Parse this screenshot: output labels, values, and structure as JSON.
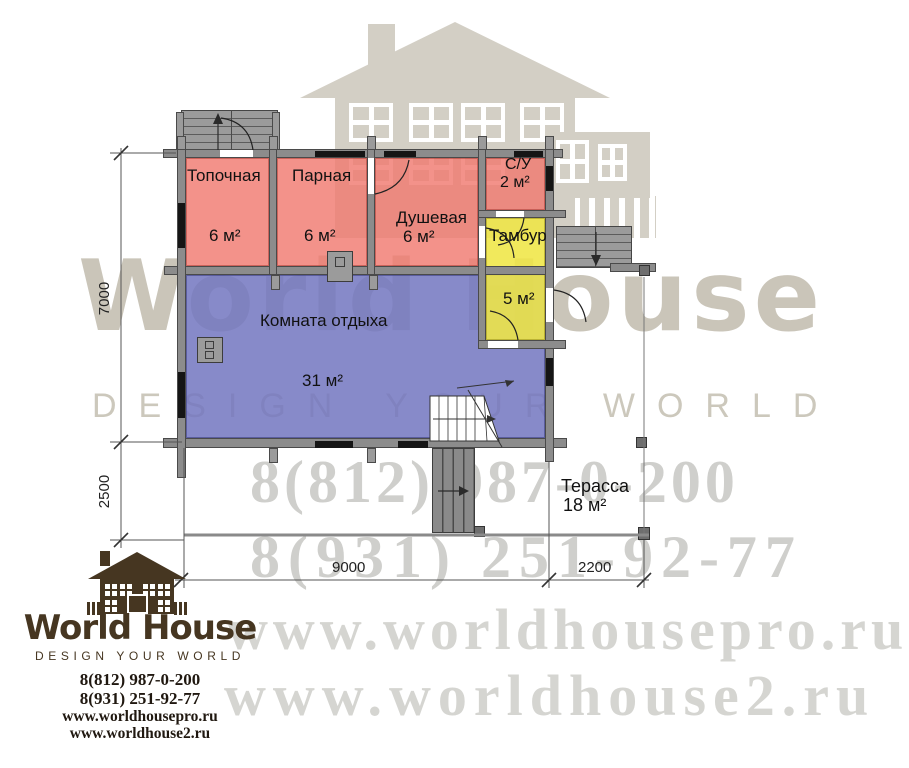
{
  "plan": {
    "rooms": {
      "topochnaya": {
        "label": "Топочная",
        "area": "6 м²"
      },
      "parnaya": {
        "label": "Парная",
        "area": "6 м²"
      },
      "dushevaya": {
        "label": "Душевая",
        "area": "6 м²"
      },
      "su": {
        "label": "С/У",
        "area": "2 м²"
      },
      "tambur": {
        "label": "Тамбур",
        "area": "5 м²"
      },
      "lounge": {
        "label": "Комната отдыха",
        "area": "31 м²"
      },
      "terrace": {
        "label": "Терасса",
        "area": "18 м²"
      }
    },
    "dimensions": {
      "height_main": "7000",
      "height_terrace": "2500",
      "width_main": "9000",
      "width_terrace": "2200"
    },
    "colors": {
      "wet_zone": "#f07a70",
      "vestibule": "#efe646",
      "lounge": "#7276c0",
      "walls": "#8c8c8c"
    }
  },
  "watermark": {
    "brand": "World House",
    "slogan": "DESIGN YOUR WORLD",
    "phone_1": "8(812) 987-0-200",
    "phone_2": "8(931) 251-92-77",
    "website_1": "www.worldhousepro.ru",
    "website_2": "www.worldhouse2.ru"
  },
  "logo": {
    "brand": "World House",
    "slogan": "DESIGN YOUR WORLD",
    "phone_1": "8(812) 987-0-200",
    "phone_2": "8(931) 251-92-77",
    "website_1": "www.worldhousepro.ru",
    "website_2": "www.worldhouse2.ru",
    "color": "#463621"
  }
}
